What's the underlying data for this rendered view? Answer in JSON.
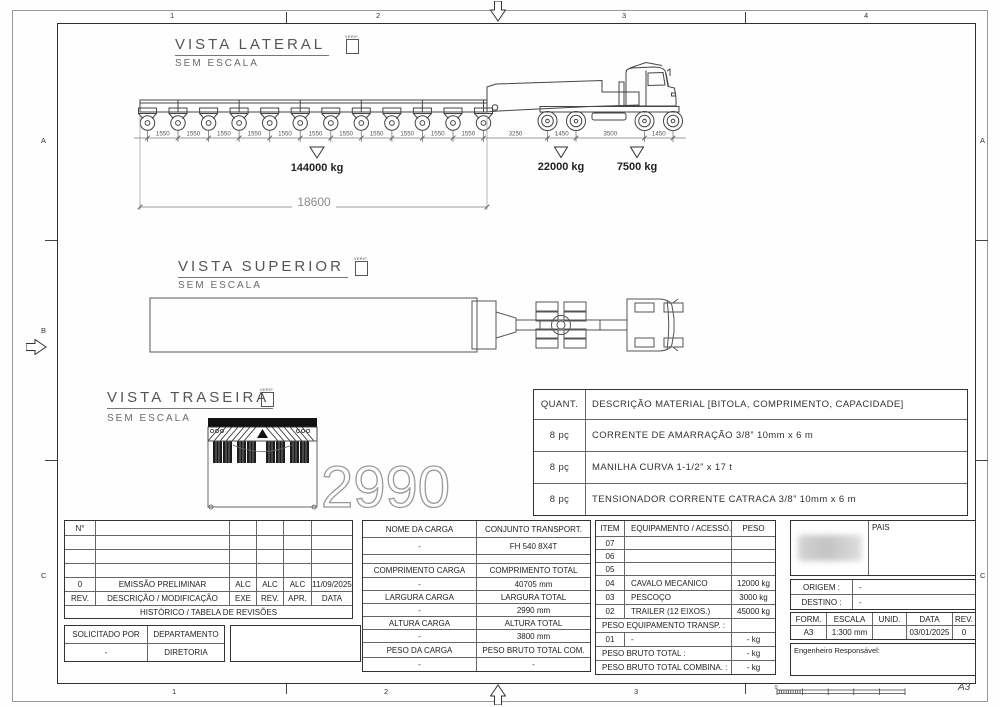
{
  "sheet": {
    "format_label": "A3",
    "scale_zero": "0",
    "grid_top": [
      "1",
      "2",
      "3",
      "4"
    ],
    "grid_bottom": [
      "1",
      "2",
      "3"
    ],
    "grid_left": [
      "A",
      "B",
      "C"
    ],
    "grid_right": [
      "A",
      "C"
    ]
  },
  "views": {
    "lateral": {
      "title": "VISTA LATERAL",
      "subtitle": "SEM ESCALA",
      "verif_label": "VERIF.",
      "trailer_axle_dims": [
        "1550",
        "1550",
        "1550",
        "1550",
        "1550",
        "1550",
        "1550",
        "1550",
        "1550",
        "1550",
        "1550"
      ],
      "tractor_dims": [
        "3250",
        "1450",
        "3500",
        "1450"
      ],
      "load_trailer": "144000 kg",
      "load_drive": "22000 kg",
      "load_front": "7500 kg",
      "overall_length": "18600"
    },
    "superior": {
      "title": "VISTA SUPERIOR",
      "subtitle": "SEM ESCALA",
      "verif_label": "VERIF."
    },
    "traseira": {
      "title": "VISTA TRASEIRA",
      "subtitle": "SEM ESCALA",
      "verif_label": "VERIF.",
      "overall_width": "2990"
    }
  },
  "materials_table": {
    "qty_header": "QUANT.",
    "desc_header": "DESCRIÇÃO MATERIAL [BITOLA, COMPRIMENTO, CAPACIDADE]",
    "rows": [
      {
        "qty": "8 pç",
        "desc": "CORRENTE DE AMARRAÇÃO 3/8” 10mm x 6 m"
      },
      {
        "qty": "8 pç",
        "desc": "MANILHA CURVA 1-1/2” x 17 t"
      },
      {
        "qty": "8 pç",
        "desc": "TENSIONADOR CORRENTE CATRACA 3/8” 10mm x 6 m"
      }
    ]
  },
  "revision_table": {
    "n_label": "N°",
    "entry": [
      "0",
      "EMISSÃO PRELIMINAR",
      "ALC",
      "ALC",
      "ALC",
      "11/09/2025"
    ],
    "headers": [
      "REV.",
      "DESCRIÇÃO / MODIFICAÇÃO",
      "EXE",
      "REV.",
      "APR.",
      "DATA"
    ],
    "footer": "HISTÓRICO / TABELA DE REVISÕES"
  },
  "request_table": {
    "headers": [
      "SOLICITADO POR",
      "DEPARTAMENTO"
    ],
    "values": [
      "-",
      "DIRETORIA"
    ]
  },
  "cargo_table": {
    "rows": [
      [
        "NOME DA CARGA",
        "CONJUNTO TRANSPORT."
      ],
      [
        "-",
        "FH 540 8X4T"
      ],
      [
        "",
        ""
      ],
      [
        "COMPRIMENTO CARGA",
        "COMPRIMENTO TOTAL"
      ],
      [
        "-",
        "40705 mm"
      ],
      [
        "LARGURA CARGA",
        "LARGURA TOTAL"
      ],
      [
        "-",
        "2990 mm"
      ],
      [
        "ALTURA CARGA",
        "ALTURA TOTAL"
      ],
      [
        "-",
        "3800 mm"
      ],
      [
        "PESO DA CARGA",
        "PESO BRUTO TOTAL COM."
      ],
      [
        "-",
        "-"
      ]
    ]
  },
  "equipment_table": {
    "headers": [
      "ITEM",
      "EQUIPAMENTO / ACESSÓ.",
      "PESO"
    ],
    "rows": [
      [
        "07",
        "",
        ""
      ],
      [
        "06",
        "",
        ""
      ],
      [
        "05",
        "",
        ""
      ],
      [
        "04",
        "CAVALO MECANICO",
        "12000 kg"
      ],
      [
        "03",
        "PESCOÇO",
        "3000 kg"
      ],
      [
        "02",
        "TRAILER (12 EIXOS.)",
        "45000 kg"
      ]
    ],
    "transp_label": "PESO EQUIPAMENTO TRANSP. :",
    "row01": [
      "01",
      "-",
      "- kg"
    ],
    "total_label": "PESO BRUTO TOTAL :",
    "total_value": "- kg",
    "combined_label": "PESO BRUTO TOTAL COMBINA. :",
    "combined_value": "- kg"
  },
  "title_block": {
    "pais_label": "PAIS",
    "origem_label": "ORIGEM :",
    "origem_value": "-",
    "destino_label": "DESTINO :",
    "destino_value": "-",
    "form_headers": [
      "FORM.",
      "ESCALA",
      "UNID.",
      "DATA",
      "REV."
    ],
    "form_values": [
      "A3",
      "1:300 mm",
      "",
      "03/01/2025",
      "0"
    ],
    "engineer_label": "Engenheiro Responsável:"
  }
}
